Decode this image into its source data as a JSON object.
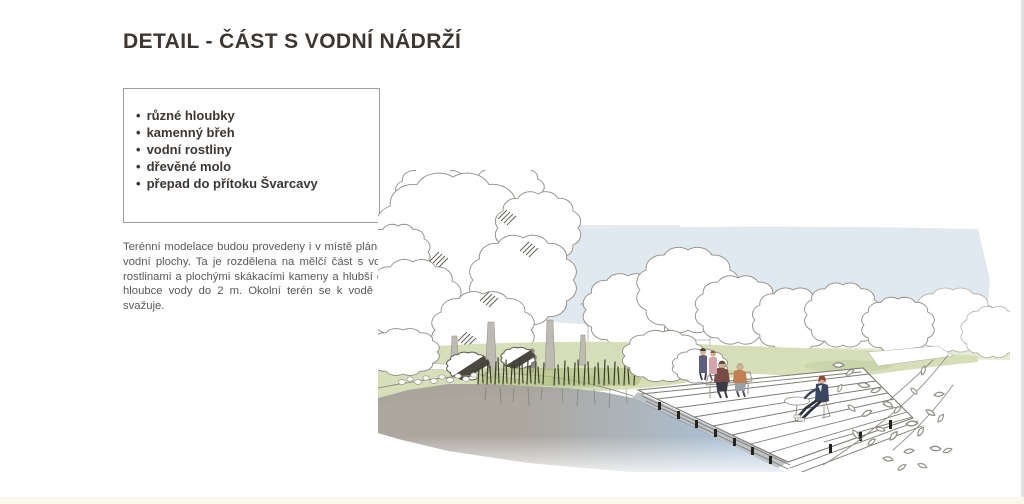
{
  "page": {
    "title": "DETAIL - ČÁST S VODNÍ NÁDRŽÍ"
  },
  "info_box": {
    "bullet": "•",
    "items": [
      "různé hloubky",
      "kamenný břeh",
      "vodní rostliny",
      "dřevěné molo",
      "přepad do přítoku Švarcavy"
    ]
  },
  "description": {
    "text": "Terénní modelace budou provedeny i v místě plánované vodní plochy. Ta je rozdělena na mělčí část s vodními rostlinami a plochými skákacími kameny a hlubší část o hloubce vody do 2 m. Okolní terén se k vodě mírně svažuje."
  },
  "illustration": {
    "subject": "hand-drawn park sketch: pond with stone bank, water plants and wooden deck with people",
    "colors": {
      "sky": "#e0e9ef",
      "grass": "#d4ddb4",
      "grass_light": "#e6ebd6",
      "grass_dark": "#c2d0a0",
      "reed_band": "#b5c084",
      "pond_brown": "#a8a29a",
      "pond_blue": "#a7bed3",
      "trunk": "#bdbab3",
      "reeds": "#383d2c",
      "deck_shadow": "#5d6a76",
      "person_maroon": "#7a4a45",
      "person_orange": "#c08050",
      "person_navy": "#39465e",
      "person_purple": "#5d5e80",
      "person_pink": "#d6a3ab",
      "skin": "#d8b28e"
    }
  }
}
